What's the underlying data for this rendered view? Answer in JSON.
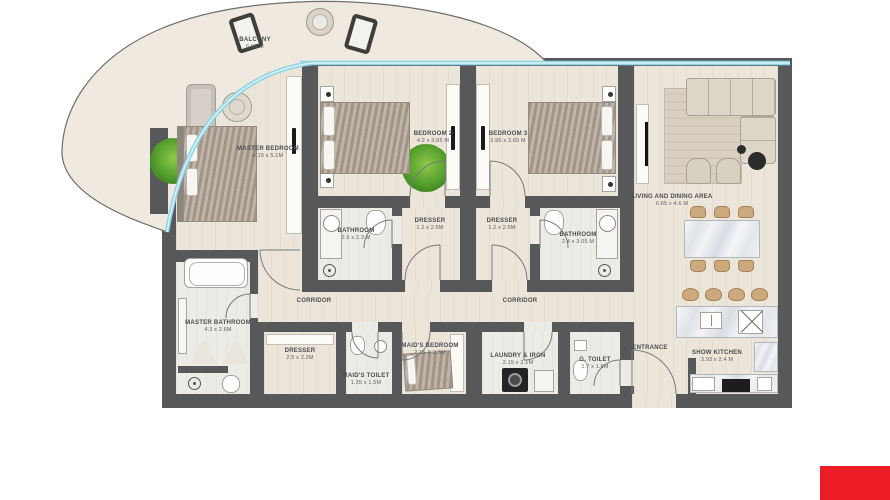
{
  "labels": {
    "balcony": {
      "name": "BALCONY",
      "dims": "6.56 M"
    },
    "master_bedroom": {
      "name": "MASTER BEDROOM",
      "dims": "4.15 x 5.1M"
    },
    "bedroom2": {
      "name": "BEDROOM 2",
      "dims": "4.2 x 3.65 M"
    },
    "bedroom3": {
      "name": "BEDROOM 3",
      "dims": "3.95 x 3.65 M"
    },
    "living": {
      "name": "LIVING AND DINING AREA",
      "dims": "6.65 x 4.6 M"
    },
    "bathroom2": {
      "name": "BATHROOM",
      "dims": "2.6 x 2.3 M"
    },
    "dresser2": {
      "name": "DRESSER",
      "dims": "1.2 x 2.6M"
    },
    "dresser3": {
      "name": "DRESSER",
      "dims": "1.2 x 2.6M"
    },
    "bathroom3": {
      "name": "BATHROOM",
      "dims": "2.4 x 3.05 M"
    },
    "corridor1": {
      "name": "CORRIDOR"
    },
    "corridor2": {
      "name": "CORRIDOR"
    },
    "master_bathroom": {
      "name": "MASTER BATHROOM",
      "dims": "4.3 x 2.6M"
    },
    "dresser_master": {
      "name": "DRESSER",
      "dims": "2.5 x 2.2M"
    },
    "maids_toilet": {
      "name": "MAID'S TOILET",
      "dims": "1.35 x 1.5M"
    },
    "maids_bedroom": {
      "name": "MAID'S BEDROOM",
      "dims": "2.15 X 2.3M"
    },
    "laundry": {
      "name": "LAUNDRY & IRON",
      "dims": "2.15 x 2.1M"
    },
    "g_toilet": {
      "name": "G. TOILET",
      "dims": "1.7 x 1.6M"
    },
    "entrance": {
      "name": "ENTRANCE"
    },
    "show_kitchen": {
      "name": "SHOW KITCHEN",
      "dims": "3.93 x 2.4 M"
    }
  },
  "colors": {
    "wall": "#57585a",
    "floor": "#ebe5da",
    "glazing": "#8fd4e6",
    "marble": "#e9ebee",
    "wood_tan": "#cda97e",
    "plant_green": "#56a02e",
    "logo_red": "#ed1c24"
  }
}
